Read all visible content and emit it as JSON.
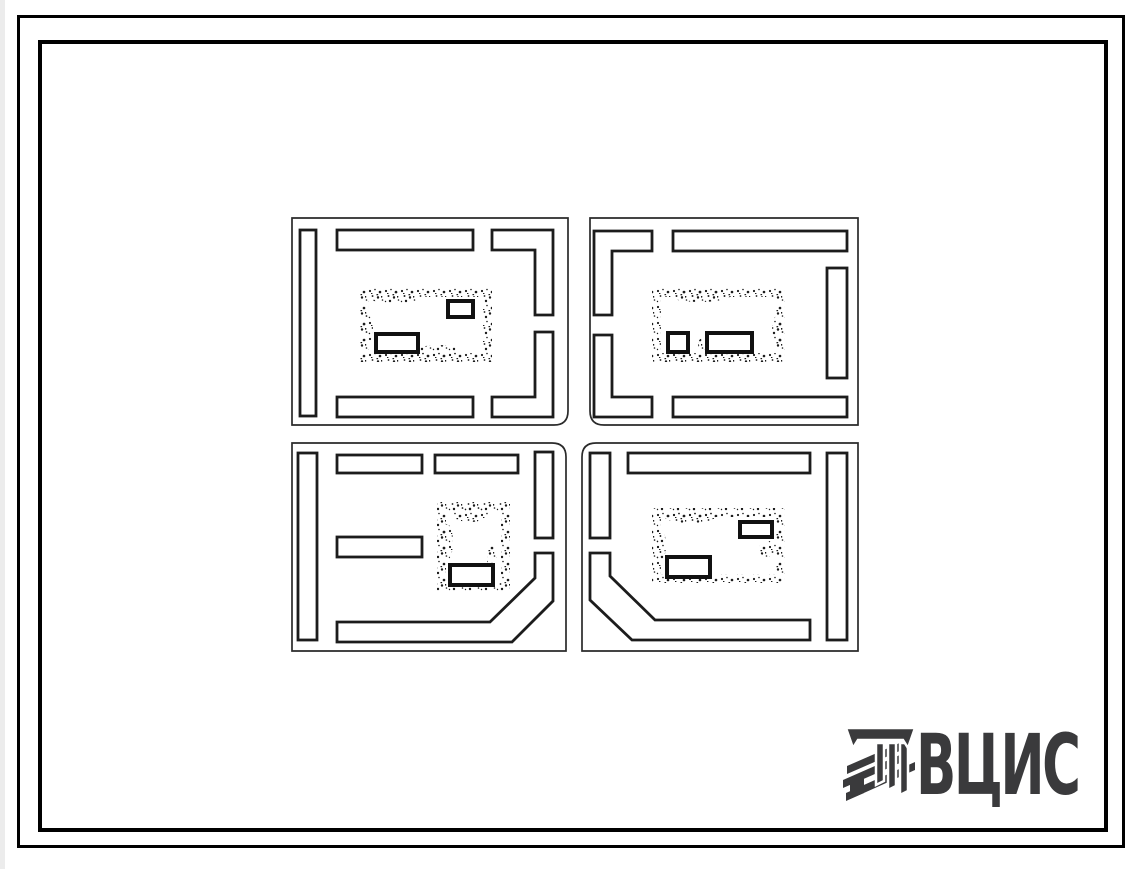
{
  "page": {
    "background_color": "#ffffff",
    "frame_color": "#000000"
  },
  "drawing": {
    "ink_color": "#1c1c1c",
    "kind": "site plan of four residential blocks at a street crossing"
  },
  "logo": {
    "text": "ВЦИС",
    "color": "#3a3a3c",
    "icon": "vcis-hatched-column-icon"
  }
}
